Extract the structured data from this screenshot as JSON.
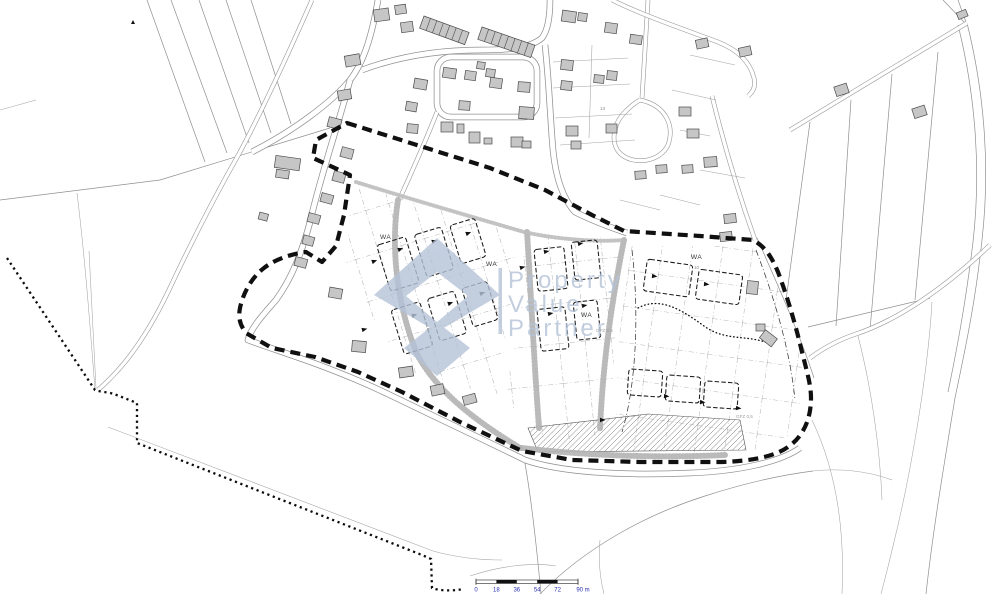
{
  "watermark": {
    "lines": [
      "Property",
      "Value",
      "Partner"
    ]
  },
  "zoning": {
    "wa1": "WA",
    "wa2": "WA",
    "wa3": "WA",
    "wa4": "WA",
    "gfz1": "GFZ 0,5",
    "gfz2": "GFZ 0,5",
    "lot10": "10",
    "lot13": "13"
  },
  "scalebar": {
    "ticks": [
      "0",
      "18",
      "36",
      "54",
      "72",
      "90 m"
    ]
  },
  "colors": {
    "building_fill": "#c6c6c6",
    "boundary": "#101010",
    "watermark": "#b5c3d8",
    "scale_text": "#2a2fb0",
    "parcel_line": "#8f8f8f"
  }
}
